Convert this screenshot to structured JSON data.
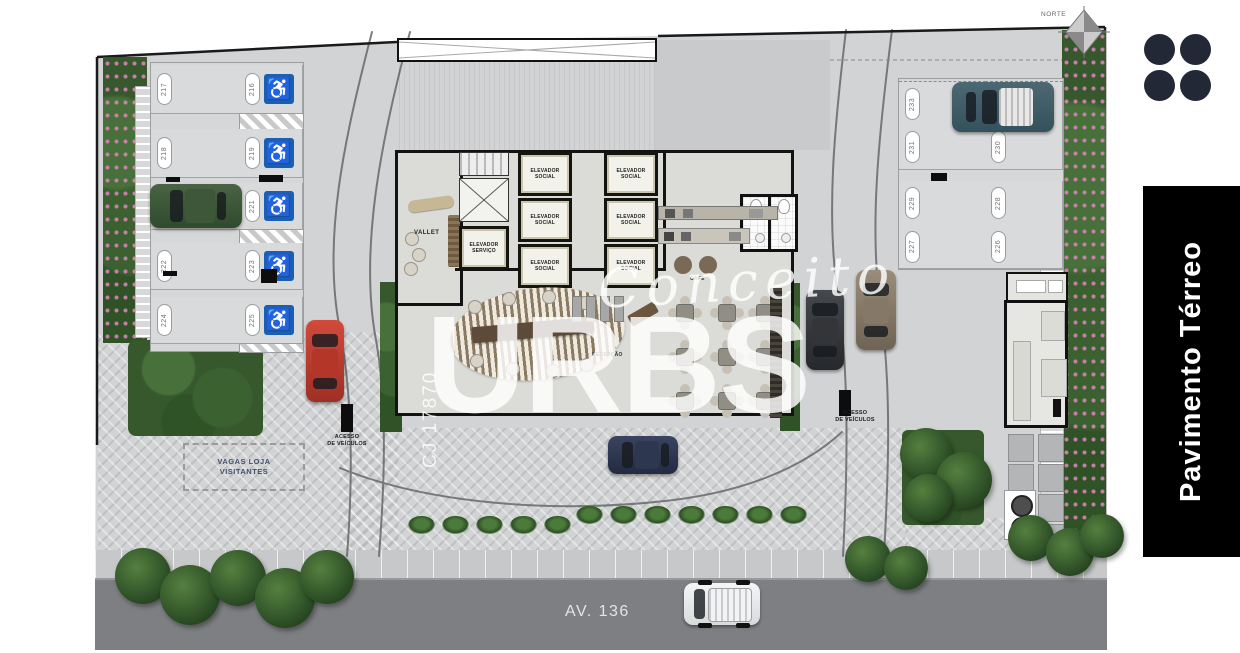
{
  "compass": {
    "label": "NORTE"
  },
  "panel": {
    "title": "Pavimento Térreo"
  },
  "logo": {
    "name": "four-dot-logo"
  },
  "watermark": {
    "script": "Conceito",
    "brand": "URBS",
    "code": "CJ 17870"
  },
  "street": {
    "name": "AV. 136"
  },
  "signs": {
    "access_line1": "ACESSO",
    "access_line2": "DE VEÍCULOS",
    "visitor_line1": "VAGAS LOJA",
    "visitor_line2": "VISITANTES"
  },
  "rooms": {
    "vallet": "VALLET",
    "elev_social_line1": "ELEVADOR",
    "elev_social_line2": "SOCIAL",
    "elev_service_line1": "ELEVADOR",
    "elev_service_line2": "SERVIÇO",
    "cafe": "CAFÉ",
    "reception": "RECEPÇÃO"
  },
  "icons": {
    "accessible": "♿"
  },
  "parking": {
    "left_a": [
      "217",
      "218",
      "220",
      "222",
      "224"
    ],
    "left_b": [
      "216",
      "219",
      "221",
      "223",
      "225"
    ],
    "right_a": [
      "233",
      "231",
      "229",
      "227"
    ],
    "right_b": [
      "232",
      "230",
      "228",
      "226"
    ]
  },
  "colors": {
    "accessible_blue": "#1a5fb4",
    "panel_bg": "#000000",
    "street_gray": "#7d7f82",
    "hedge_green": "#36582c",
    "flower_pink": "#d884b8"
  }
}
